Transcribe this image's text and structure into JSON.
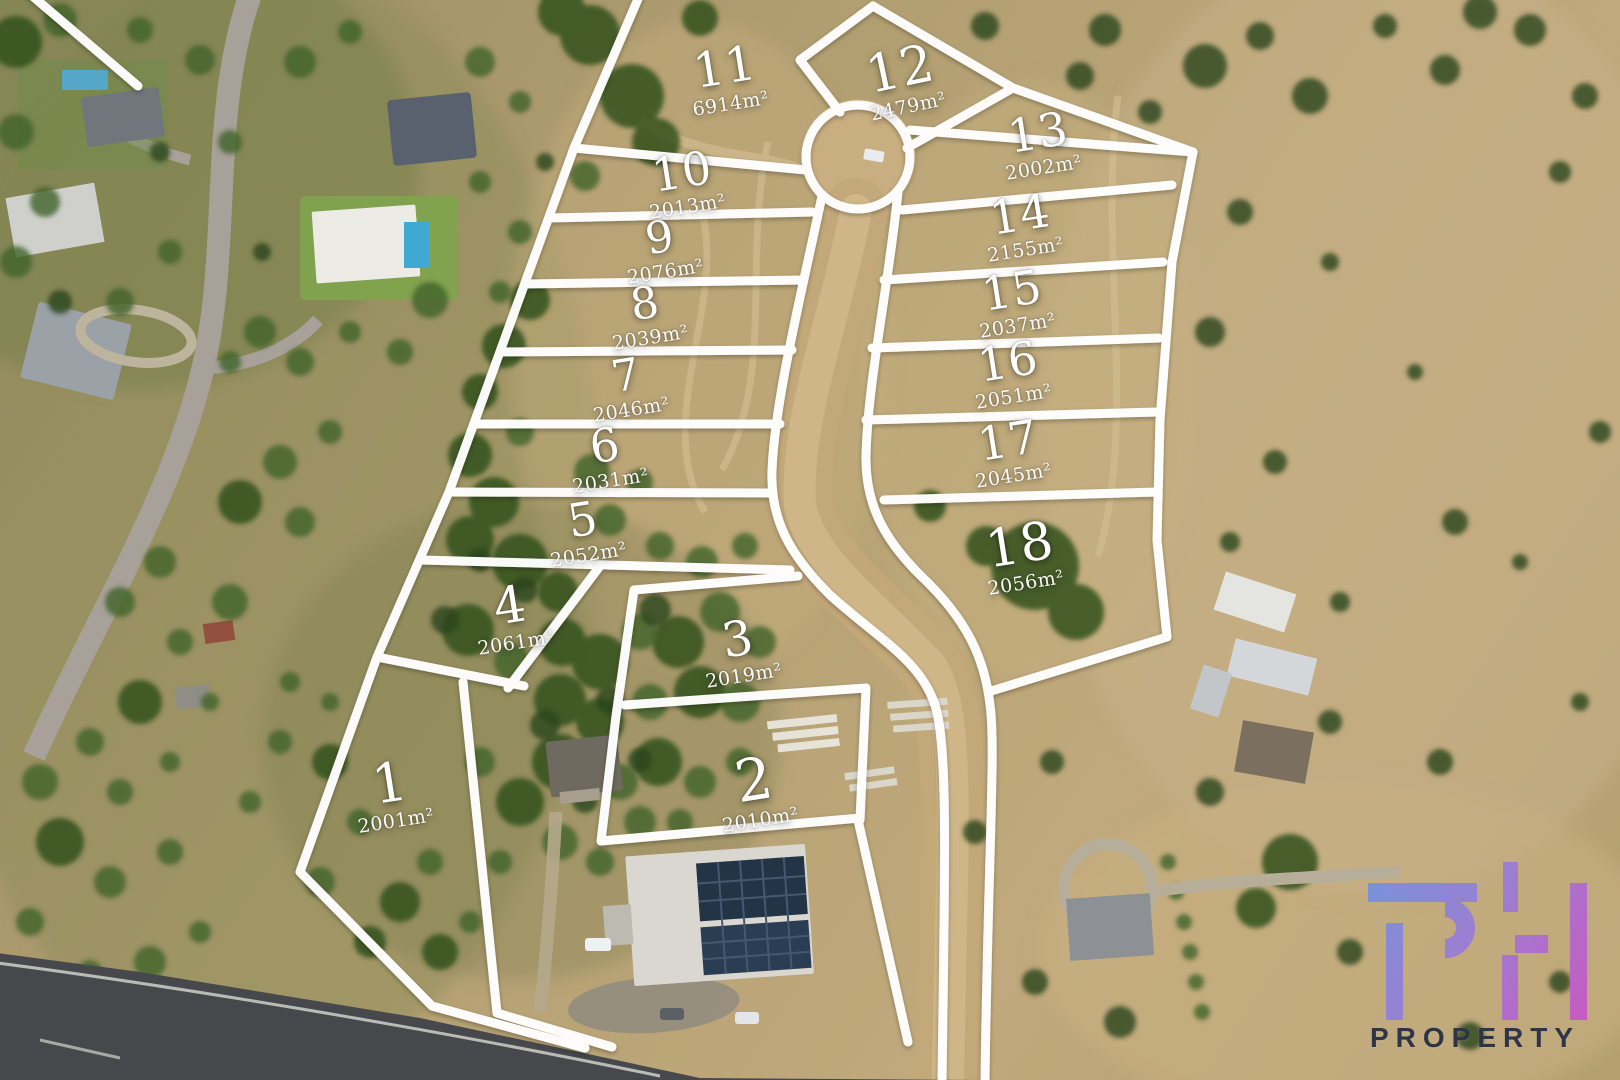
{
  "title": "Residential land estate aerial lot plan",
  "lots": [
    {
      "number": "1",
      "area": "2001m²"
    },
    {
      "number": "2",
      "area": "2010m²"
    },
    {
      "number": "3",
      "area": "2019m²"
    },
    {
      "number": "4",
      "area": "2061m²"
    },
    {
      "number": "5",
      "area": "2052m²"
    },
    {
      "number": "6",
      "area": "2031m²"
    },
    {
      "number": "7",
      "area": "2046m²"
    },
    {
      "number": "8",
      "area": "2039m²"
    },
    {
      "number": "9",
      "area": "2076m²"
    },
    {
      "number": "10",
      "area": "2013m²"
    },
    {
      "number": "11",
      "area": "6914m²"
    },
    {
      "number": "12",
      "area": "2479m²"
    },
    {
      "number": "13",
      "area": "2002m²"
    },
    {
      "number": "14",
      "area": "2155m²"
    },
    {
      "number": "15",
      "area": "2037m²"
    },
    {
      "number": "16",
      "area": "2051m²"
    },
    {
      "number": "17",
      "area": "2045m²"
    },
    {
      "number": "18",
      "area": "2056m²"
    }
  ],
  "logo": {
    "mark": "PH",
    "wordmark": "PROPERTY",
    "gradient_start": "#6f94e0",
    "gradient_mid": "#9b7ad8",
    "gradient_end": "#c855c8",
    "wordmark_color": "#2e3546"
  },
  "overlay": {
    "line_color": "#ffffff"
  }
}
